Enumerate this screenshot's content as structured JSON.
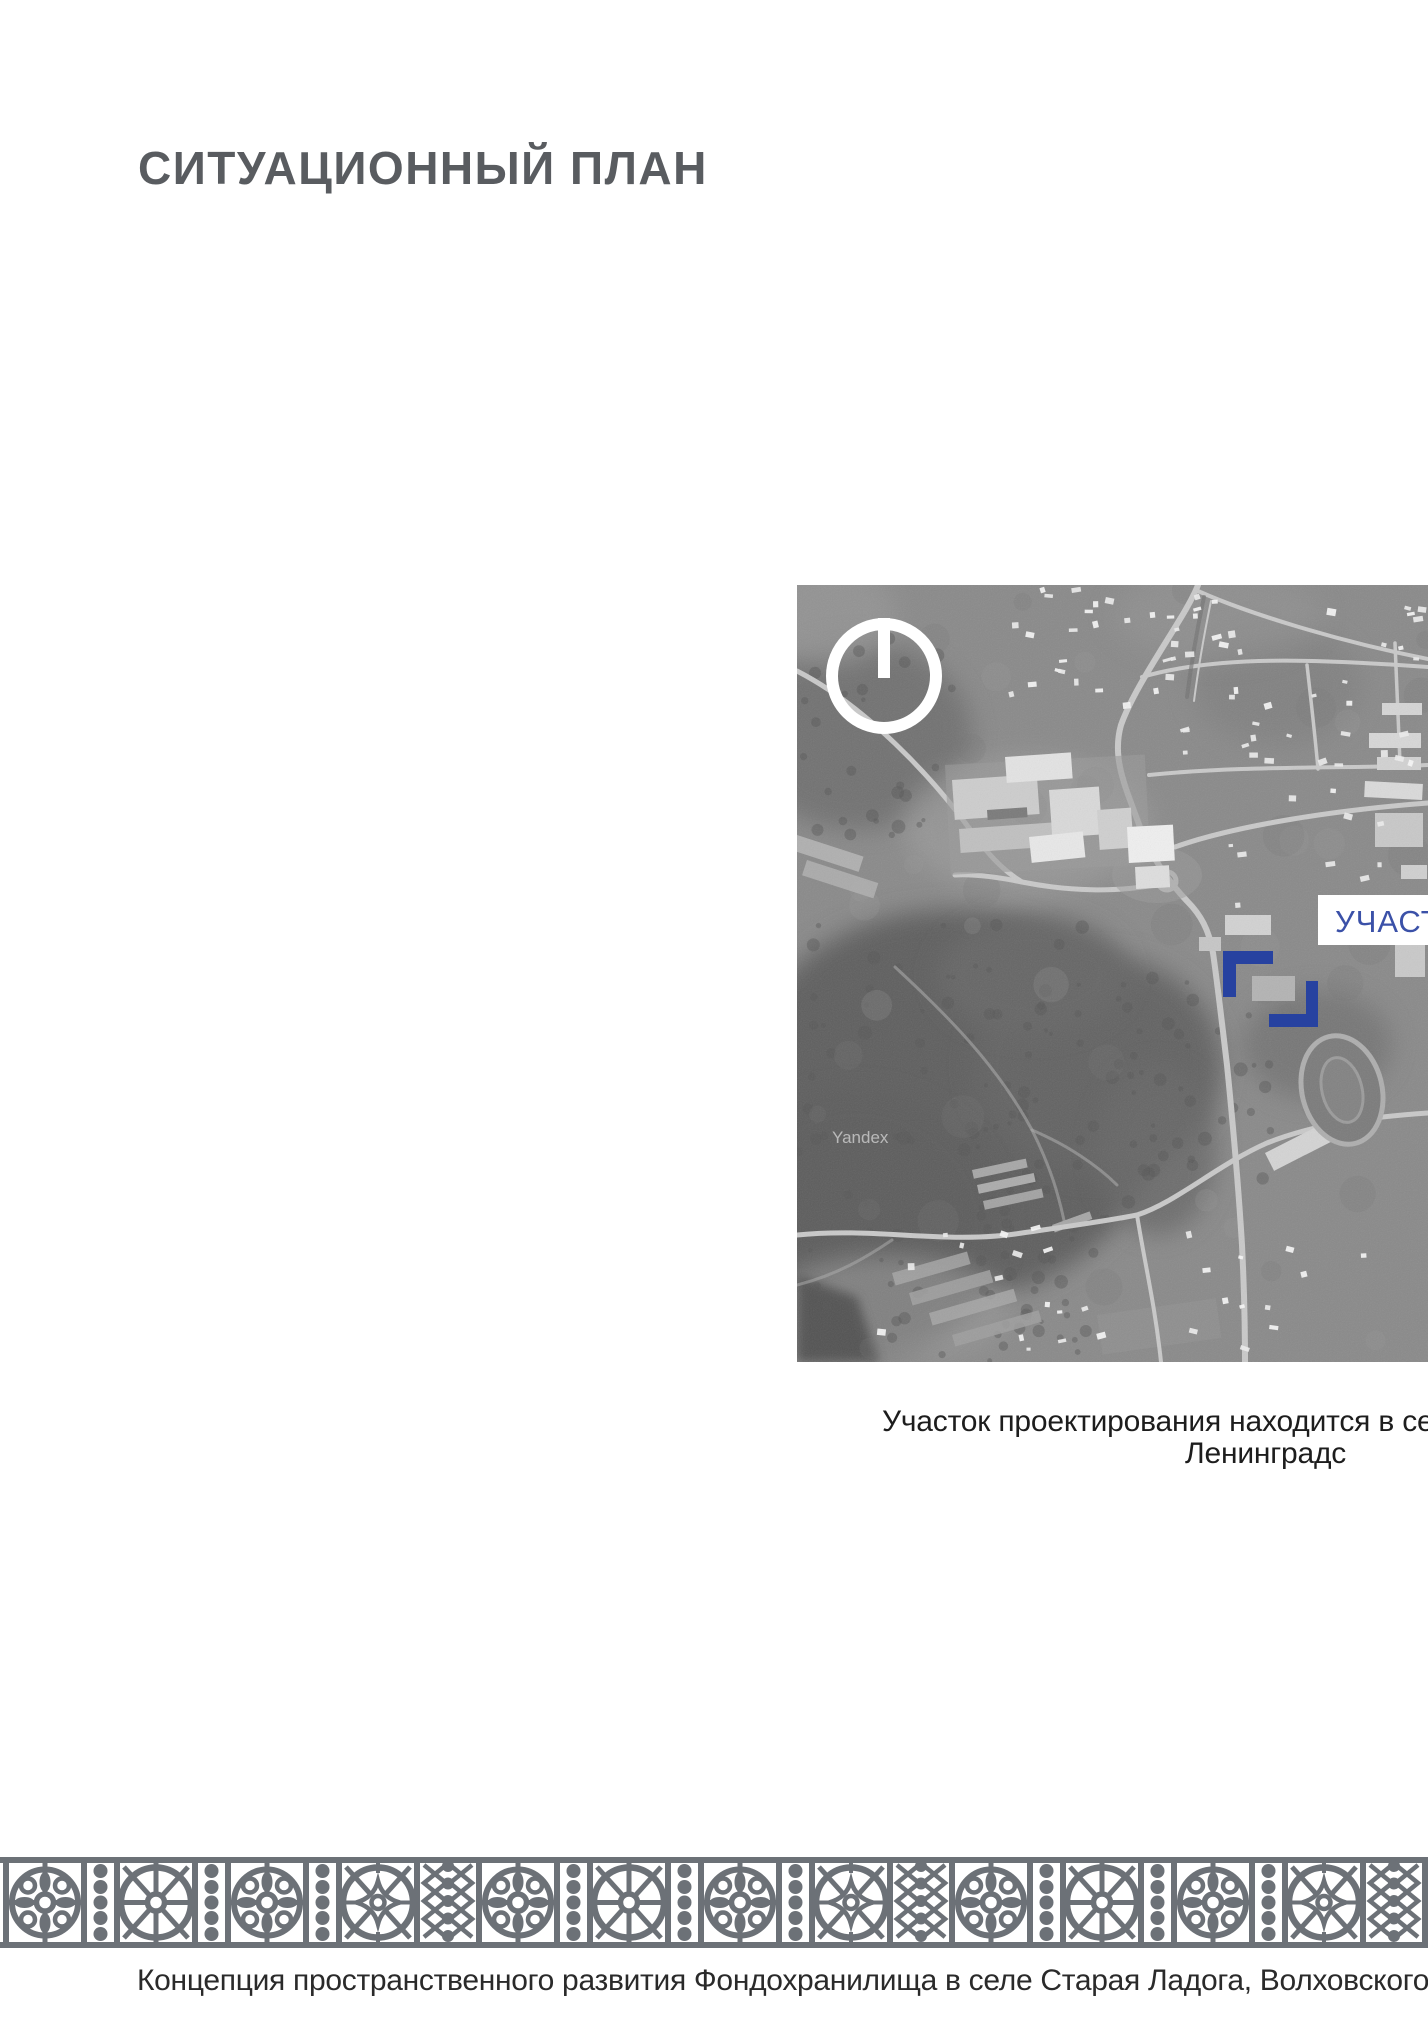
{
  "title": "СИТУАЦИОННЫЙ ПЛАН",
  "map": {
    "site_label": "УЧАСТ",
    "watermark": "Yandex",
    "caption_line1": "Участок проектирования находится в се",
    "caption_line2": "Ленинградс"
  },
  "footer": {
    "text": "Концепция пространственного развития Фондохранилища в селе Старая Ладога, Волховского района, Ленинградско"
  },
  "colors": {
    "accent_blue": "#2742a0",
    "label_blue": "#3b51a8",
    "title_gray": "#595c60",
    "ornament_gray": "#6c7177",
    "text_dark": "#1d1d1d"
  }
}
